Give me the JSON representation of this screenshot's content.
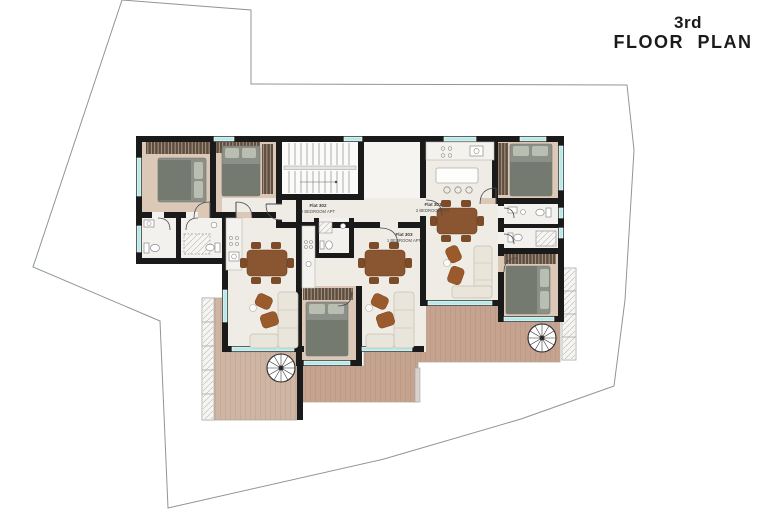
{
  "title": {
    "line1": "3rd",
    "line2": "FLOOR PLAN"
  },
  "flats": [
    {
      "name": "Flat 301",
      "type": "2 BEDROOM APT"
    },
    {
      "name": "Flat 302",
      "type": "2 BEDROOM APT"
    },
    {
      "name": "Flat 303",
      "type": "1 BEDROOM APT"
    }
  ],
  "colors": {
    "wall": "#1a1a1a",
    "window_glass": "#b6e9e8",
    "deck_wood": "#c8a38e",
    "deck_wood_light": "#cfb5a3",
    "bedroom_floor": "#dbc8b6",
    "living_floor": "#efece6",
    "bath_floor": "#f3f1ed",
    "furniture_wood": "#8a5531",
    "bed_fabric": "#878b84",
    "sofa": "#e9e5da",
    "wardrobe": "#5d4e41",
    "boundary_line": "#8e9698",
    "title_text": "#1b1b1b"
  }
}
